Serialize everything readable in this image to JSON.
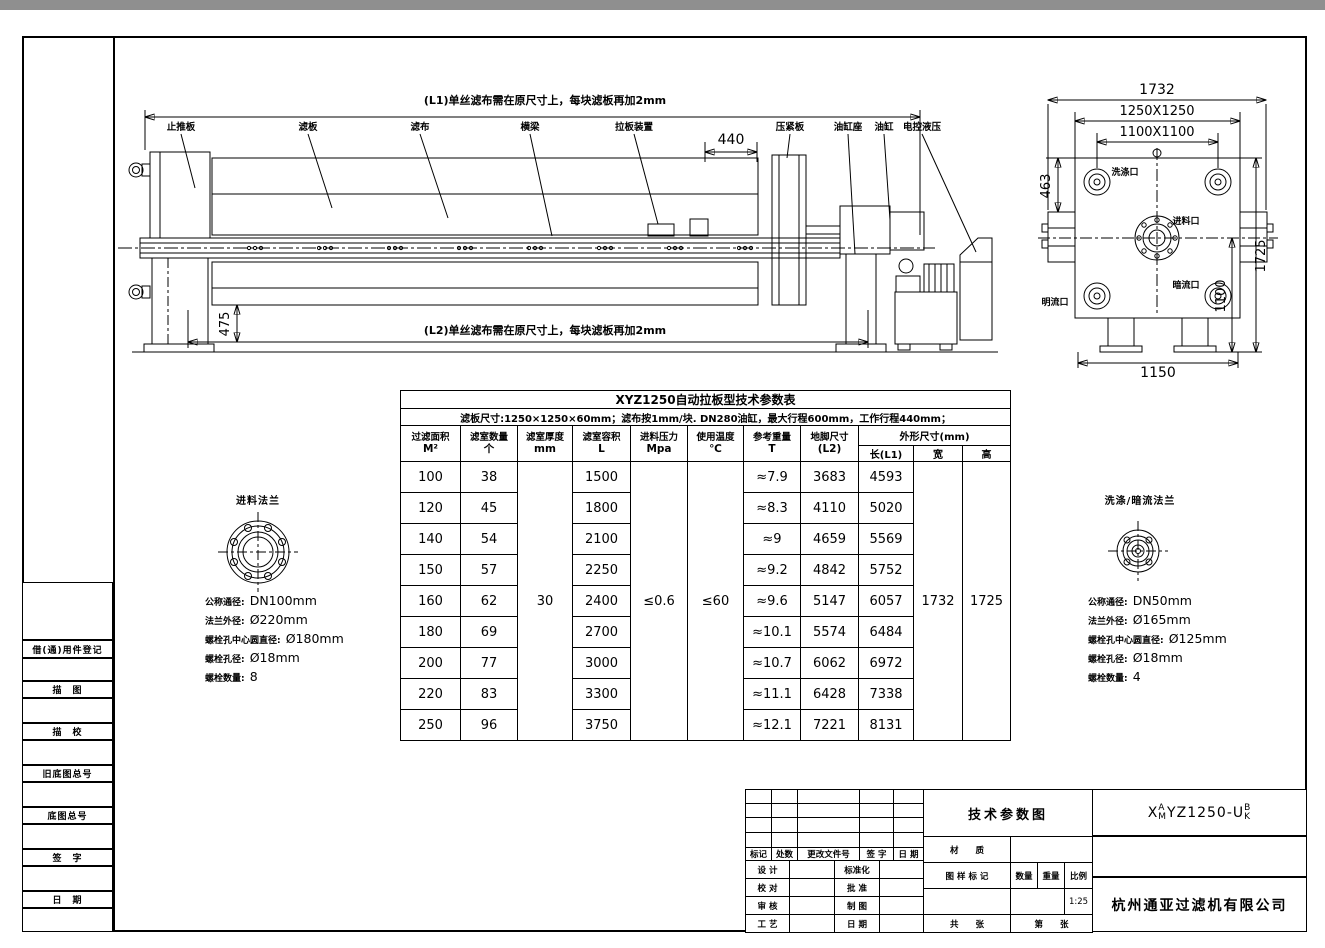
{
  "colors": {
    "paper": "#ffffff",
    "line": "#000000",
    "top_bar": "#8f8f8f"
  },
  "side_view": {
    "note_l1": "(L1)单丝滤布需在原尺寸上，每块滤板再加2mm",
    "note_l2": "(L2)单丝滤布需在原尺寸上，每块滤板再加2mm",
    "dim_stroke": "440",
    "dim_foot": "475",
    "part_labels": {
      "thrust_plate": "止推板",
      "filter_plate": "滤板",
      "filter_cloth": "滤布",
      "beam": "横梁",
      "plate_shifter": "拉板装置",
      "press_plate": "压紧板",
      "cylinder_seat": "油缸座",
      "cylinder": "油缸",
      "hydraulic": "电控液压"
    }
  },
  "end_view": {
    "dim_1732": "1732",
    "dim_1250": "1250X1250",
    "dim_1100sq": "1100X1100",
    "dim_463": "463",
    "dim_1725": "1725",
    "dim_1100": "1100",
    "dim_1150": "1150",
    "port_wash": "洗涤口",
    "port_feed": "进料口",
    "port_dark": "暗流口",
    "port_open": "明流口"
  },
  "spec_table": {
    "title": "XYZ1250自动拉板型技术参数表",
    "subtitle": "滤板尺寸:1250×1250×60mm；滤布按1mm/块. DN280油缸，最大行程600mm，工作行程440mm；",
    "headers": {
      "area": "过滤面积",
      "area_u": "M²",
      "chambers": "滤室数量",
      "chambers_u": "个",
      "thickness": "滤室厚度",
      "thickness_u": "mm",
      "volume": "滤室容积",
      "volume_u": "L",
      "pressure": "进料压力",
      "pressure_u": "Mpa",
      "temp": "使用温度",
      "temp_u": "℃",
      "weight": "参考重量",
      "weight_u": "T",
      "foot": "地脚尺寸",
      "foot_u": "(L2)",
      "overall": "外形尺寸(mm)",
      "len": "长(L1)",
      "width": "宽",
      "height": "高"
    },
    "merged": {
      "thickness": "30",
      "pressure": "≤0.6",
      "temp": "≤60",
      "width": "1732",
      "height": "1725"
    },
    "rows": [
      [
        "100",
        "38",
        "1500",
        "≈7.9",
        "3683",
        "4593"
      ],
      [
        "120",
        "45",
        "1800",
        "≈8.3",
        "4110",
        "5020"
      ],
      [
        "140",
        "54",
        "2100",
        "≈9",
        "4659",
        "5569"
      ],
      [
        "150",
        "57",
        "2250",
        "≈9.2",
        "4842",
        "5752"
      ],
      [
        "160",
        "62",
        "2400",
        "≈9.6",
        "5147",
        "6057"
      ],
      [
        "180",
        "69",
        "2700",
        "≈10.1",
        "5574",
        "6484"
      ],
      [
        "200",
        "77",
        "3000",
        "≈10.7",
        "6062",
        "6972"
      ],
      [
        "220",
        "83",
        "3300",
        "≈11.1",
        "6428",
        "7338"
      ],
      [
        "250",
        "96",
        "3750",
        "≈12.1",
        "7221",
        "8131"
      ]
    ]
  },
  "feed_flange": {
    "title": "进料法兰",
    "specs": [
      {
        "label": "公称通径:",
        "value": "DN100mm"
      },
      {
        "label": "法兰外径:",
        "value": "Ø220mm"
      },
      {
        "label": "螺栓孔中心圆直径:",
        "value": "Ø180mm"
      },
      {
        "label": "螺栓孔径:",
        "value": "Ø18mm"
      },
      {
        "label": "螺栓数量:",
        "value": "8"
      }
    ]
  },
  "wash_flange": {
    "title": "洗涤/暗流法兰",
    "specs": [
      {
        "label": "公称通径:",
        "value": "DN50mm"
      },
      {
        "label": "法兰外径:",
        "value": "Ø165mm"
      },
      {
        "label": "螺栓孔中心圆直径:",
        "value": "Ø125mm"
      },
      {
        "label": "螺栓孔径:",
        "value": "Ø18mm"
      },
      {
        "label": "螺栓数量:",
        "value": "4"
      }
    ]
  },
  "margin_strip": {
    "labels": [
      "借(通)用件登记",
      "描　图",
      "描　校",
      "旧底图总号",
      "底图总号",
      "签　字",
      "日　期"
    ]
  },
  "title_block": {
    "rev_headers": [
      "标记",
      "处数",
      "更改文件号",
      "签 字",
      "日 期"
    ],
    "sign_rows": [
      [
        "设 计",
        "标准化"
      ],
      [
        "校 对",
        "批 准"
      ],
      [
        "审 核",
        "制 图"
      ],
      [
        "工 艺",
        "日 期"
      ]
    ],
    "drawing_title": "技术参数图",
    "material_label": "材　　质",
    "mark_label": "图 样 标 记",
    "qty_label": "数量",
    "weight_label": "重量",
    "scale_label": "比例",
    "scale_value": "1:25",
    "total_label": "共　　张",
    "no_label": "第　　张",
    "code": {
      "prefix": "X",
      "stack1": [
        "A",
        "M"
      ],
      "middle": "YZ1250-U",
      "stack2": [
        "B",
        "K"
      ]
    },
    "company": "杭州通亚过滤机有限公司"
  }
}
